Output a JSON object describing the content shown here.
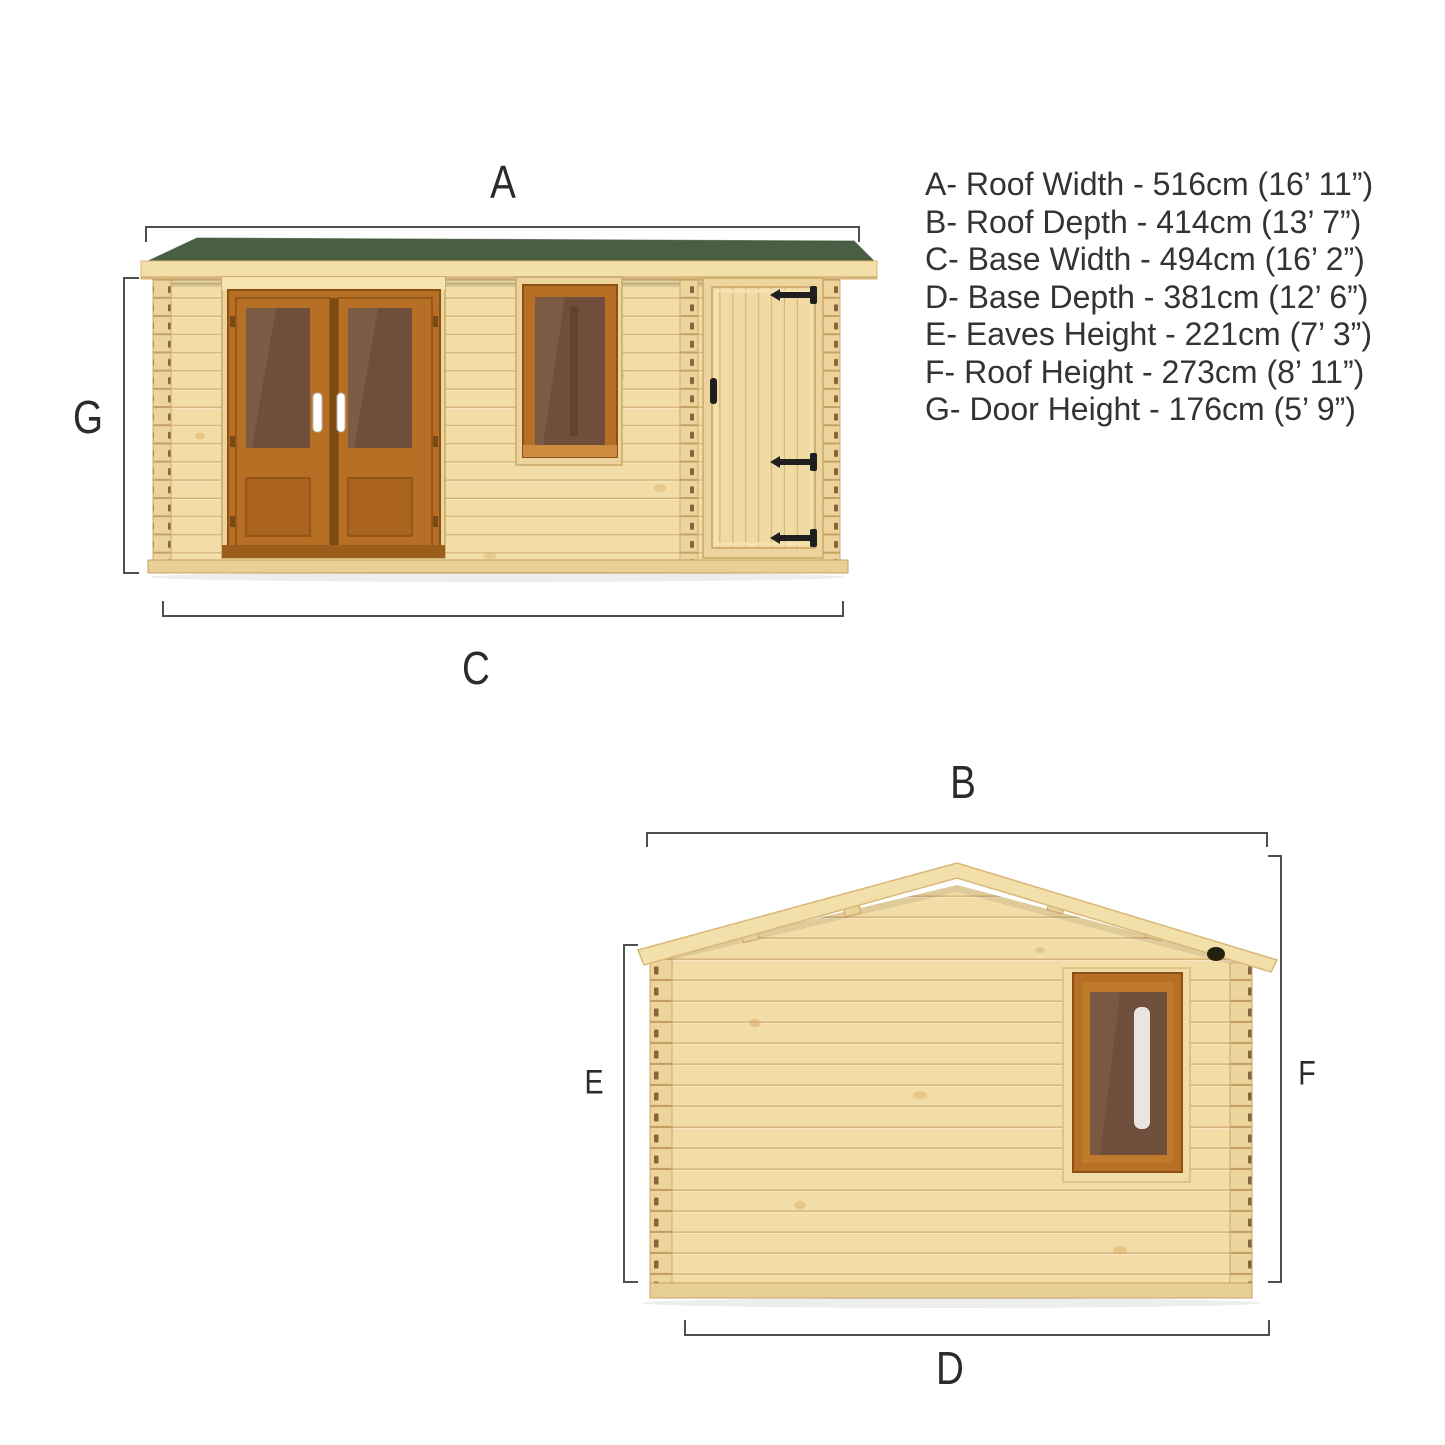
{
  "legend": {
    "items": [
      {
        "key": "A",
        "name": "Roof Width",
        "metric": "516cm",
        "imperial": "16’ 11”",
        "text": "A- Roof Width - 516cm (16’ 11”)"
      },
      {
        "key": "B",
        "name": "Roof Depth",
        "metric": "414cm",
        "imperial": "13’ 7”",
        "text": "B- Roof Depth - 414cm (13’ 7”)"
      },
      {
        "key": "C",
        "name": "Base Width",
        "metric": "494cm",
        "imperial": "16’ 2”",
        "text": "C- Base Width - 494cm (16’ 2”)"
      },
      {
        "key": "D",
        "name": "Base Depth",
        "metric": "381cm",
        "imperial": "12’ 6”",
        "text": "D- Base Depth - 381cm (12’ 6”)"
      },
      {
        "key": "E",
        "name": "Eaves Height",
        "metric": "221cm",
        "imperial": "7’ 3”",
        "text": "E- Eaves Height - 221cm (7’ 3”)"
      },
      {
        "key": "F",
        "name": "Roof Height",
        "metric": "273cm",
        "imperial": "8’ 11”",
        "text": "F- Roof Height - 273cm (8’ 11”)"
      },
      {
        "key": "G",
        "name": "Door Height",
        "metric": "176cm",
        "imperial": "5’ 9”",
        "text": "G- Door Height - 176cm (5’ 9”)"
      }
    ]
  },
  "front_view": {
    "top": "A",
    "bottom": "C",
    "left": "G"
  },
  "side_view": {
    "top": "B",
    "bottom": "D",
    "left": "E",
    "right": "F"
  },
  "colors": {
    "background": "#ffffff",
    "roof_felt_green": "#4a5e43",
    "wood_light": "#f2dda7",
    "wood_trim": "#ecd49c",
    "oak_frame": "#b76f26",
    "glass_tint": "#6f4f3b",
    "hinge_black": "#1f1f1f",
    "dim_line": "#4f4f4f",
    "text_dark": "#333333"
  }
}
